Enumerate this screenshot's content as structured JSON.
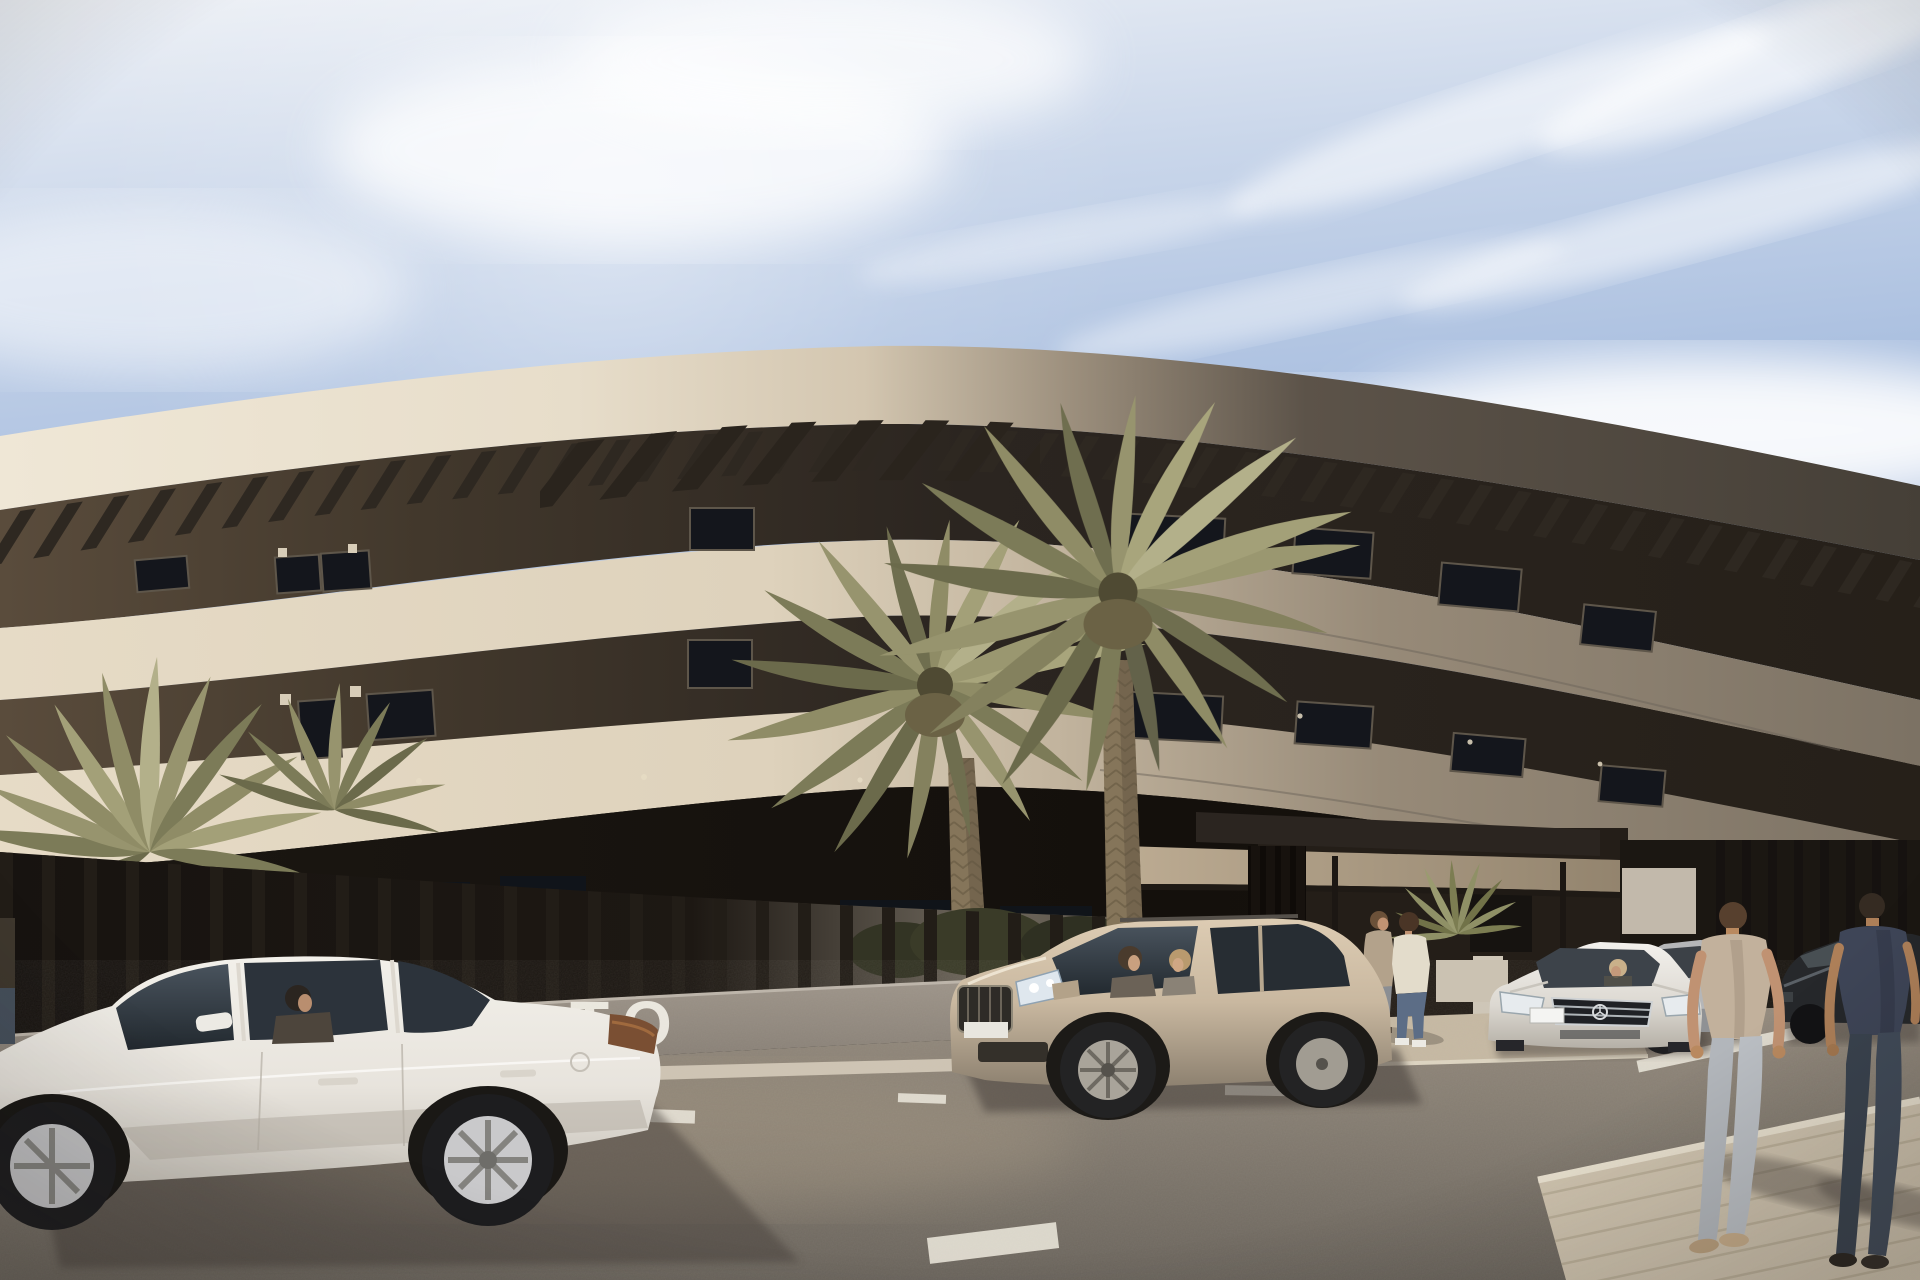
{
  "scene": {
    "description": "Sunny photorealistic architectural rendering of a long curved cream apartment building with dark recessed balcony floors and rooftop pergola slats, fronted by a slatted perimeter fence on a grey wall, tall palm trees, parked cars (white sedan with driver, champagne SUV with two occupants, white Mercedes sedan with driver, silver car, dark sedan), two men standing at the entrance under a flat canopy and two men walking away on the right sidewalk under a pale blue sky with wispy clouds",
    "wall_sign": {
      "text": "TO",
      "color": "#f2efe7"
    },
    "objects": [
      "sky",
      "clouds",
      "curved-apartment-building",
      "rooftop-pergola",
      "balcony-bands",
      "slatted-fence",
      "perimeter-wall",
      "palm-trees",
      "entrance-canopy",
      "white-sedan",
      "champagne-suv",
      "white-mercedes",
      "silver-car",
      "dark-sedan",
      "standing-pedestrians",
      "walking-pedestrians",
      "road",
      "lane-markings",
      "sidewalk"
    ]
  },
  "palette": {
    "sky-top": "#eef1f6",
    "sky-mid": "#c9d6ea",
    "sky-deep": "#abc0e0",
    "cream-bright": "#efe7d6",
    "cream": "#e7ddca",
    "cream2": "#e6dbc6",
    "band-shadow": "#7c7264",
    "dark-face": "#453f37",
    "recess": "#262019",
    "fence": "#221d17",
    "wall": "#a0978c",
    "wall-dark": "#7b736a",
    "road": "#948a7d",
    "road-dark": "#6a645c",
    "marking": "#e8e3d7",
    "sidewalk": "#cfc3ae",
    "canopy": "#bcab92",
    "palm": "#9a9770",
    "palm-dark": "#6b6a4b",
    "palm-light": "#b3b08a",
    "trunk": "#85755a",
    "car-white": "#f2f0ea",
    "car-champagne": "#c9b8a0",
    "car-silver": "#b5b6b8",
    "car-dark": "#26282b",
    "skin": "#c09272",
    "tee-tan": "#c2b19c",
    "tee-navy": "#3e4557",
    "jeans-light": "#b2b6bb",
    "jeans-dark": "#3a434f",
    "sweater": "#e3dccb",
    "cardigan": "#b3a28b",
    "sign": "#f2efe7",
    "shadow": "#46403a"
  }
}
